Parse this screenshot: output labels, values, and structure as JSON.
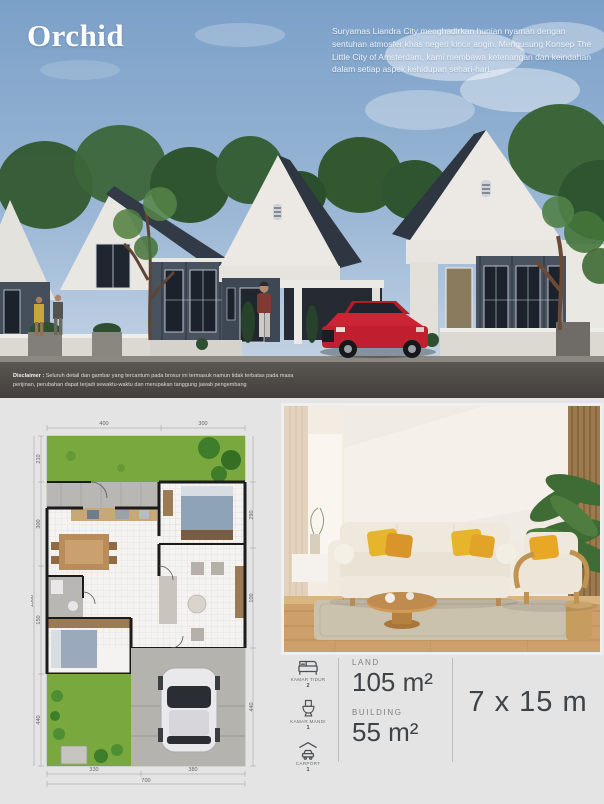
{
  "brand": {
    "name": "Orchid"
  },
  "hero": {
    "description": "Suryamas Liandra City menghadirkan hunian nyaman dengan sentuhan atmosfer khas negeri kincir angin. Mengusung Konsep The Little City of Amsterdam, kami membawa ketenangan dan keindahan dalam setiap aspek kehidupan sehari-hari.",
    "disclaimer_label": "Disclaimer :",
    "disclaimer_line1": "Seluruh detail dan gambar yang tercantum pada brosur ini termasuk namun tidak terbatas pada masa",
    "disclaimer_line2": "perijinan, perubahan dapat terjadi sewaktu-waktu dan merupakan tanggung jawab pengembang"
  },
  "plan": {
    "dims_top": [
      "400",
      "300"
    ],
    "dims_left": [
      "210",
      "300",
      "150",
      "440"
    ],
    "dim_left_total": "1500",
    "dims_right": [
      "290",
      "100",
      "440"
    ],
    "dims_bottom": [
      "330",
      "380"
    ],
    "dim_bottom_total": "700"
  },
  "specs": {
    "features": [
      {
        "icon": "bed-icon",
        "label": "KAMAR TIDUR",
        "value": "2"
      },
      {
        "icon": "bath-icon",
        "label": "KAMAR MANDI",
        "value": "1"
      },
      {
        "icon": "carport-icon",
        "label": "CARPORT",
        "value": "1"
      }
    ],
    "land_label": "LAND",
    "land_value": "105 m²",
    "building_label": "BUILDING",
    "building_value": "55 m²",
    "plot_size": "7 x 15 m"
  },
  "colors": {
    "sky_top": "#7ba0c8",
    "sky_bottom": "#c7d5e6",
    "house_slate": "#49525f",
    "house_white": "#ece9e4",
    "car_red": "#bf1f2e",
    "garden_green": "#79a83e",
    "page_gray": "#e4e4e4",
    "text_dark": "#3d4347"
  }
}
